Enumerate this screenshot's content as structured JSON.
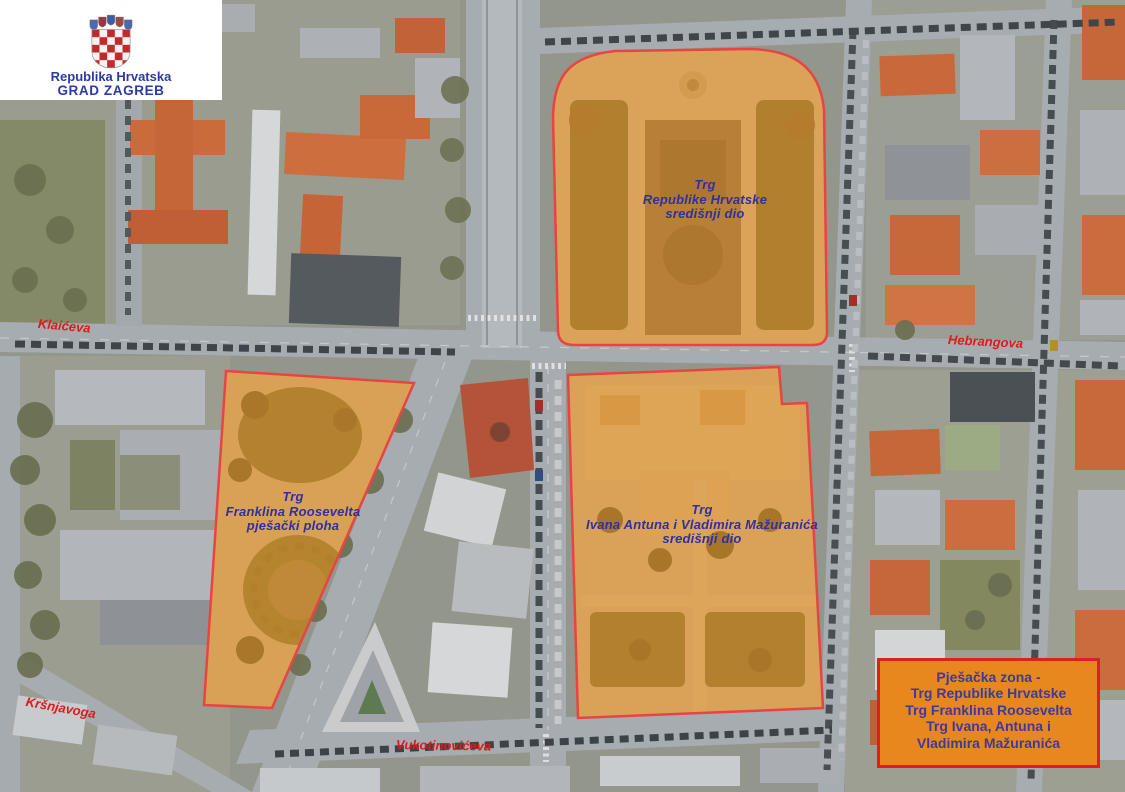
{
  "header": {
    "country": "Republika Hrvatska",
    "city": "GRAD ZAGREB",
    "emblem_icon": "croatian-coat-of-arms"
  },
  "zones": [
    {
      "label_lines": [
        "Trg",
        "Republike Hrvatske",
        "središnji dio"
      ]
    },
    {
      "label_lines": [
        "Trg",
        "Franklina Roosevelta",
        "pješački ploha"
      ]
    },
    {
      "label_lines": [
        "Trg",
        "Ivana Antuna i Vladimira Mažuranića",
        "središnji dio"
      ]
    }
  ],
  "streets": [
    {
      "name": "Klaićeva"
    },
    {
      "name": "Hebrangova"
    },
    {
      "name": "Kršnjavoga"
    },
    {
      "name": "Vukotinovićeva"
    }
  ],
  "legend": {
    "lines": [
      "Pješačka zona -",
      "Trg Republike Hrvatske",
      "Trg Franklina Roosevelta",
      "Trg Ivana, Antuna i",
      "Vladimira Mažuranića"
    ]
  },
  "colors": {
    "zone_fill": "#ee8c10",
    "zone_border": "#e94444",
    "zone_label": "#2f2fa6",
    "street_label": "#e01a1a",
    "legend_fill": "#e8871e",
    "legend_border": "#dd1f1f",
    "legend_text": "#3b3b9e",
    "header_text": "#2b3aa4"
  }
}
